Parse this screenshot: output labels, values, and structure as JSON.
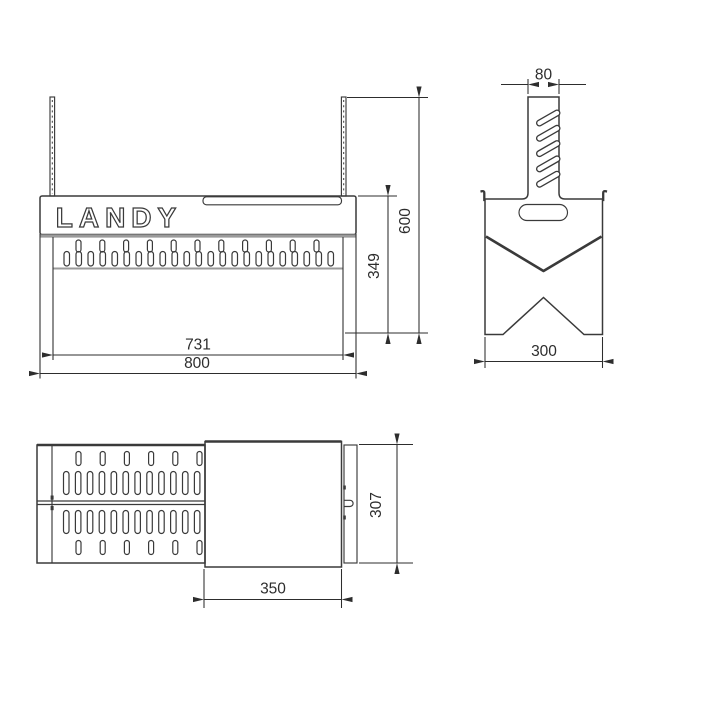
{
  "brand_cutout": "LANDY",
  "front_view": {
    "dim_inner_width": "731",
    "dim_overall_width": "800",
    "dim_body_height": "349",
    "dim_overall_height": "600"
  },
  "side_view": {
    "dim_post_width": "80",
    "dim_overall_width": "300"
  },
  "top_view": {
    "dim_plate_width": "350",
    "dim_overall_depth": "307"
  },
  "colors": {
    "line": "#3a3a3a",
    "dim": "#2d2d2d",
    "shelf": "#9a9a9a",
    "background": "#ffffff"
  }
}
